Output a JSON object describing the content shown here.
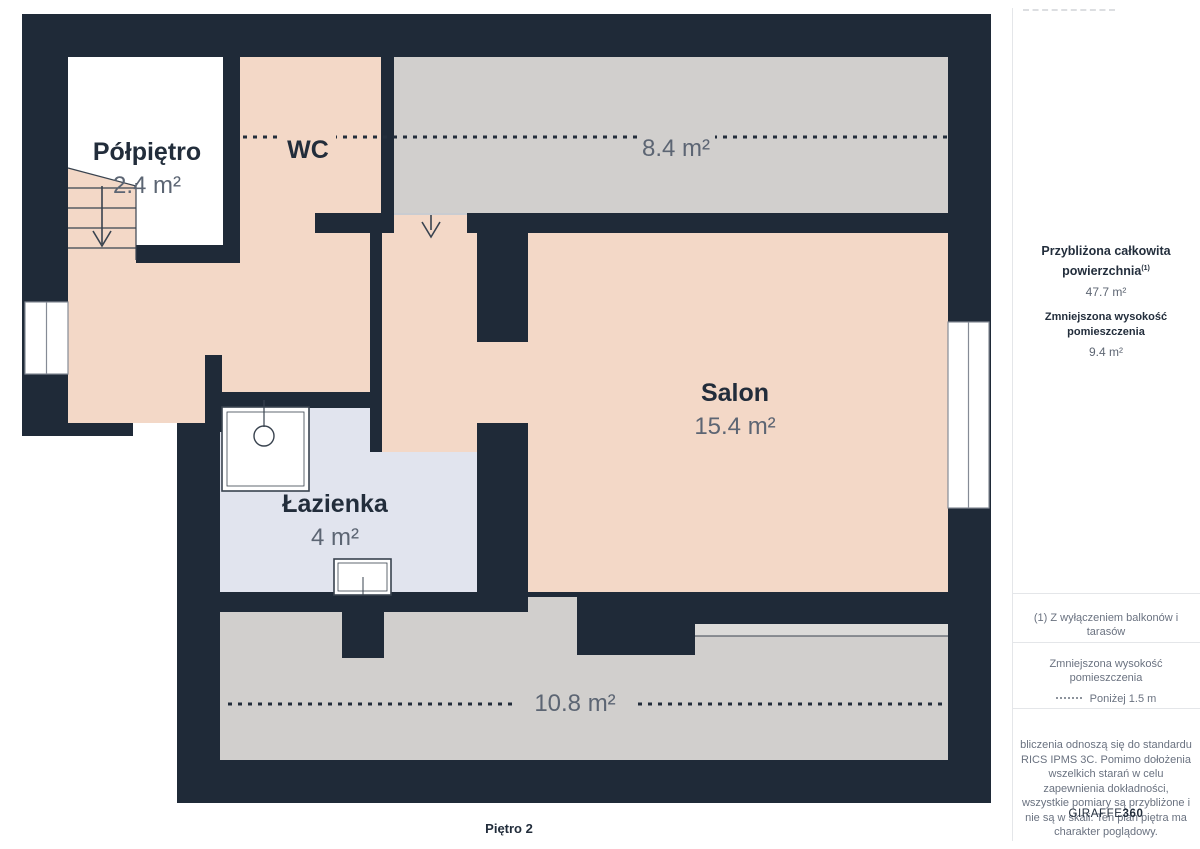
{
  "plan": {
    "floor_label": "Piętro 2",
    "rooms": [
      {
        "id": "polpietro",
        "name": "Półpiętro",
        "area": "2.4 m²"
      },
      {
        "id": "wc",
        "name": "WC",
        "area": ""
      },
      {
        "id": "reduced-height-top",
        "name": "",
        "area": "8.4 m²"
      },
      {
        "id": "salon",
        "name": "Salon",
        "area": "15.4 m²"
      },
      {
        "id": "lazienka",
        "name": "Łazienka",
        "area": "4 m²"
      },
      {
        "id": "reduced-height-bottom",
        "name": "",
        "area": "10.8 m²"
      }
    ],
    "colors": {
      "wall": "#1F2A38",
      "floor_pink": "#F3D8C7",
      "floor_gray": "#D1CFCD",
      "floor_lavender": "#E1E4EE",
      "step_light": "#DCDBD9",
      "text_dark": "#222D3B",
      "text_gray": "#5C6573"
    }
  },
  "sidebar": {
    "summary": {
      "total_label_line1": "Przybliżona całkowita",
      "total_label_line2": "powierzchnia",
      "total_footnote_marker": "(1)",
      "total_value": "47.7 m²",
      "reduced_label": "Zmniejszona wysokość pomieszczenia",
      "reduced_value": "9.4 m²"
    },
    "footnote": "(1) Z wyłączeniem balkonów i tarasów",
    "legend": {
      "title": "Zmniejszona wysokość pomieszczenia",
      "item": "Poniżej 1.5 m"
    },
    "disclaimer": "bliczenia odnoszą się do standardu RICS IPMS 3C. Pomimo dołożenia wszelkich starań w celu zapewnienia dokładności, wszystkie pomiary są przybliżone i nie są w skali. Ten plan piętra ma charakter poglądowy.",
    "brand": {
      "regular": "GIRAFFE",
      "bold": "360"
    }
  }
}
